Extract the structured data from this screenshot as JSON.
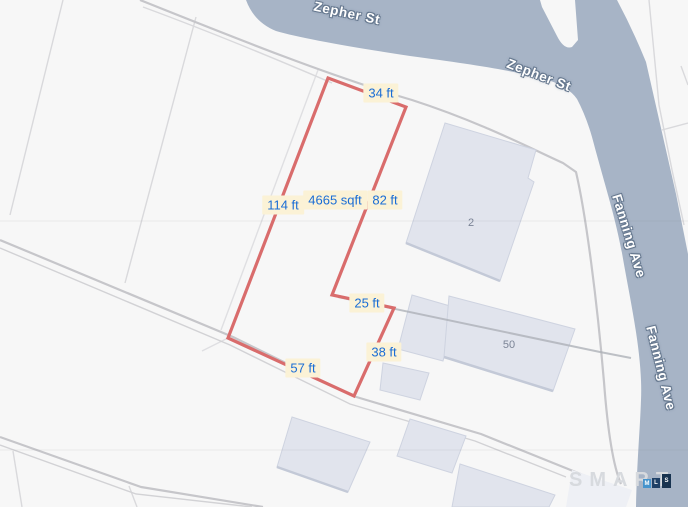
{
  "map": {
    "streets": [
      {
        "name": "Zepher St",
        "label_instances": [
          {
            "x": 347,
            "y": 13,
            "rotate": 12
          },
          {
            "x": 539,
            "y": 75,
            "rotate": 21
          }
        ]
      },
      {
        "name": "Fanning Ave",
        "label_instances": [
          {
            "x": 629,
            "y": 236,
            "rotate": 73
          },
          {
            "x": 661,
            "y": 368,
            "rotate": 76
          }
        ]
      }
    ],
    "parcel": {
      "outline_points": "328,78 406,107 332,295 394,308 354,396 228,338",
      "measurements": [
        {
          "text": "34 ft",
          "x": 381,
          "y": 93
        },
        {
          "text": "114 ft",
          "x": 283,
          "y": 205
        },
        {
          "text": "4665 sqft",
          "x": 335,
          "y": 200
        },
        {
          "text": "82 ft",
          "x": 385,
          "y": 200
        },
        {
          "text": "25 ft",
          "x": 367,
          "y": 303
        },
        {
          "text": "38 ft",
          "x": 384,
          "y": 352
        },
        {
          "text": "57 ft",
          "x": 303,
          "y": 368
        }
      ]
    },
    "buildings": [
      {
        "label": "2",
        "x": 471,
        "y": 223
      },
      {
        "label": "50",
        "x": 509,
        "y": 345
      }
    ],
    "watermark": {
      "word": "SMART",
      "blocks": [
        {
          "letter": "M",
          "color": "#4593cc",
          "x": 643,
          "y": 479,
          "w": 8,
          "h": 9
        },
        {
          "letter": "L",
          "color": "#1f4066",
          "x": 652,
          "y": 478,
          "w": 8,
          "h": 10
        },
        {
          "letter": "S",
          "color": "#183350",
          "x": 662,
          "y": 474,
          "w": 9,
          "h": 14
        }
      ]
    },
    "colors": {
      "street_fill": "#a7b4c6",
      "parcel_outline": "#d96c6c",
      "measure_bg": "#fbf2d6",
      "measure_text": "#1a6dd5",
      "street_label_halo": "#66788f",
      "building_fill": "#e1e4ed",
      "building_label": "#7b8496"
    }
  }
}
